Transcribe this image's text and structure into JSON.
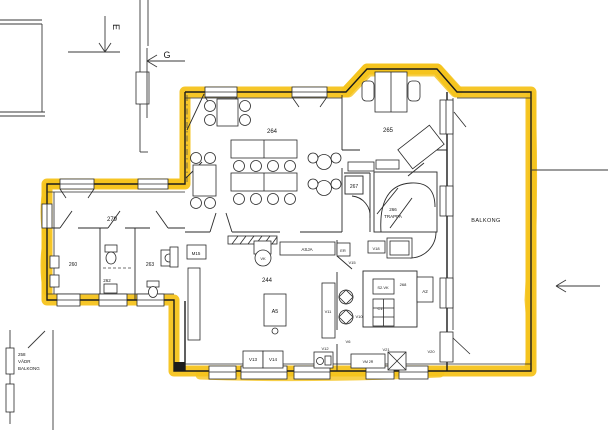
{
  "colors": {
    "highlight": "#F5C31C",
    "ink": "#1b1b1b",
    "paper": "#ffffff"
  },
  "section_markers": {
    "e": "E",
    "g": "G"
  },
  "rooms": {
    "hall264": "264",
    "room265": "265",
    "room267": "267",
    "stair_number": "266",
    "stair_name": "TRAPPA",
    "kitchen": "244",
    "corridor": "279",
    "room260": "260",
    "room262": "262",
    "room263": "263",
    "balcony": "BALKONG",
    "neighbor_l1": "258",
    "neighbor_l2": "VÄDR",
    "neighbor_l3": "BALKONG"
  },
  "equipment": {
    "m15": "M15",
    "vk": "VK",
    "asja": "ASJA",
    "er": "ER",
    "v15": "V15",
    "a5": "A5",
    "v6": "V6",
    "v10": "V10",
    "v11": "V11",
    "v12": "V12",
    "v13": "V13",
    "v14": "V14",
    "v18": "V18",
    "s2vk": "S2.VK",
    "box268": "268",
    "c1": "C1",
    "a2": "A2",
    "v20": "V20",
    "v21": "V21",
    "vm": "VM 2R"
  }
}
